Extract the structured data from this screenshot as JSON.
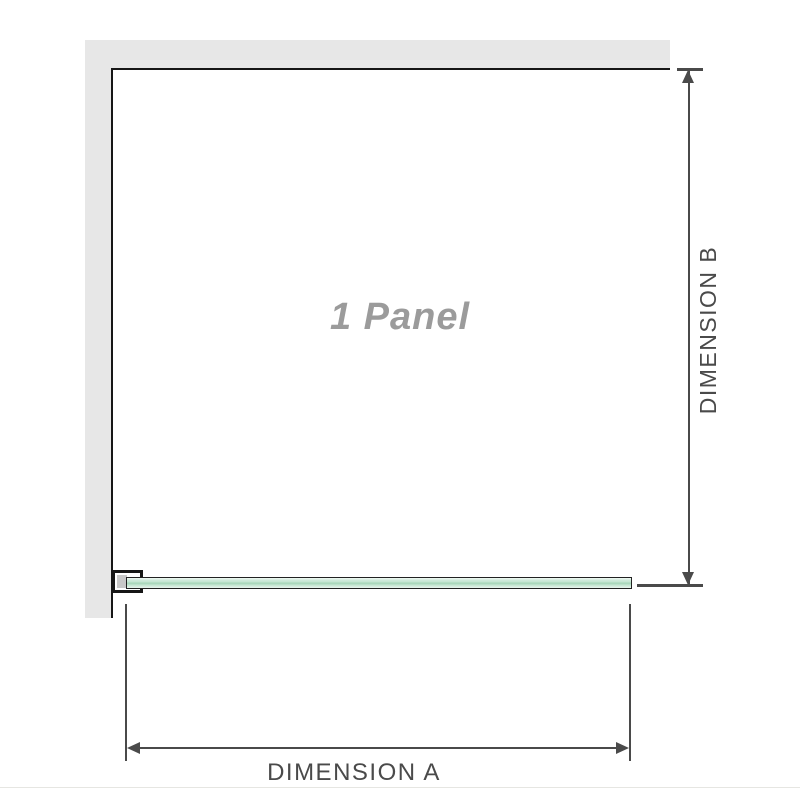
{
  "diagram": {
    "panel_label": "1 Panel",
    "dimension_a_label": "DIMENSION A",
    "dimension_b_label": "DIMENSION B"
  },
  "colors": {
    "wall": "#e7e7e7",
    "outline": "#161616",
    "dimension": "#4a4a4a",
    "glass_light": "#c5e6d2",
    "glass_dark": "#a5d6b8",
    "panel_text": "#9b9b9b"
  }
}
